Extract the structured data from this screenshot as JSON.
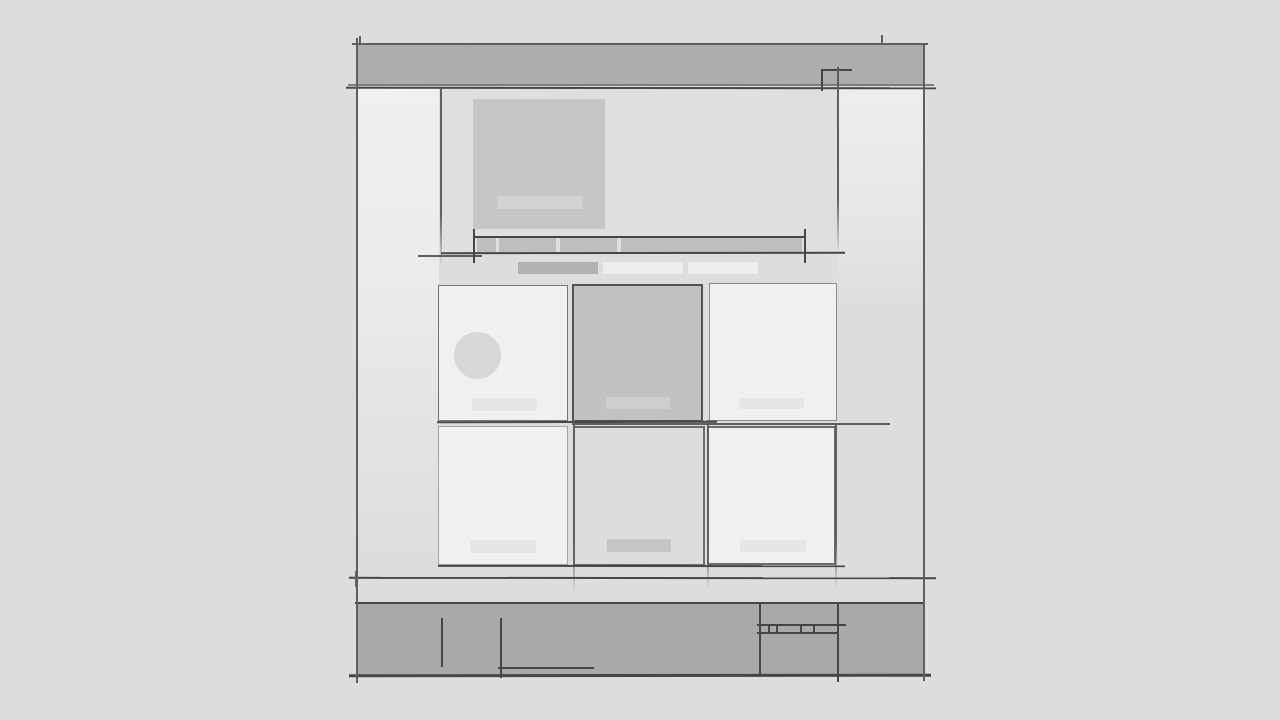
{
  "app": {
    "type": "wireframe-sketch",
    "description": "Hand-drawn grayscale website wireframe mockup on a sketch canvas"
  },
  "palette": {
    "bg": "#dfdfdf",
    "hero_area": "#e1e1e1",
    "header_fill": "#acacac",
    "footer_fill": "#a8a8a8",
    "line_dark": "#3f3f3f",
    "line_mid": "#5a5a5a",
    "line_soft": "#7a7a7a",
    "hero_box": "#c7c7c7",
    "hero_caption": "#d5d5d5",
    "strip_fill": "#bebebe",
    "chip_dark": "#b2b2b2",
    "chip_light": "#f1f1f1",
    "card_light": "#f3f3f3",
    "card_dark": "#c3c3c3",
    "avatar_fill": "#d9d9d9",
    "label_light": "#e9e9e9",
    "label_mid": "#cfcfcf",
    "label_dark": "#c7c7c7"
  },
  "wireframe": {
    "header": {
      "present": true,
      "corner_mark": true,
      "top_tick_count": 2
    },
    "hero": {
      "image_placeholder": true,
      "caption_placeholder": true
    },
    "nav_strip": {
      "segment_count": 4,
      "bracket_marks": 2
    },
    "chip_row": {
      "chip_count": 3,
      "dark_chips": 1,
      "light_chips": 2
    },
    "card_grid": {
      "rows": 2,
      "columns": 3,
      "cards": [
        {
          "row": 1,
          "col": 1,
          "variant": "light",
          "has_avatar": true,
          "has_label": true
        },
        {
          "row": 1,
          "col": 2,
          "variant": "dark",
          "has_avatar": false,
          "has_label": true
        },
        {
          "row": 1,
          "col": 3,
          "variant": "light",
          "has_avatar": false,
          "has_label": true
        },
        {
          "row": 2,
          "col": 1,
          "variant": "light",
          "has_avatar": false,
          "has_label": true
        },
        {
          "row": 2,
          "col": 2,
          "variant": "ghost",
          "has_avatar": false,
          "has_label": true
        },
        {
          "row": 2,
          "col": 3,
          "variant": "light",
          "has_avatar": false,
          "has_label": true
        }
      ]
    },
    "footer": {
      "stroke_marks": 3,
      "mini_table": {
        "divider_count": 4
      }
    }
  }
}
